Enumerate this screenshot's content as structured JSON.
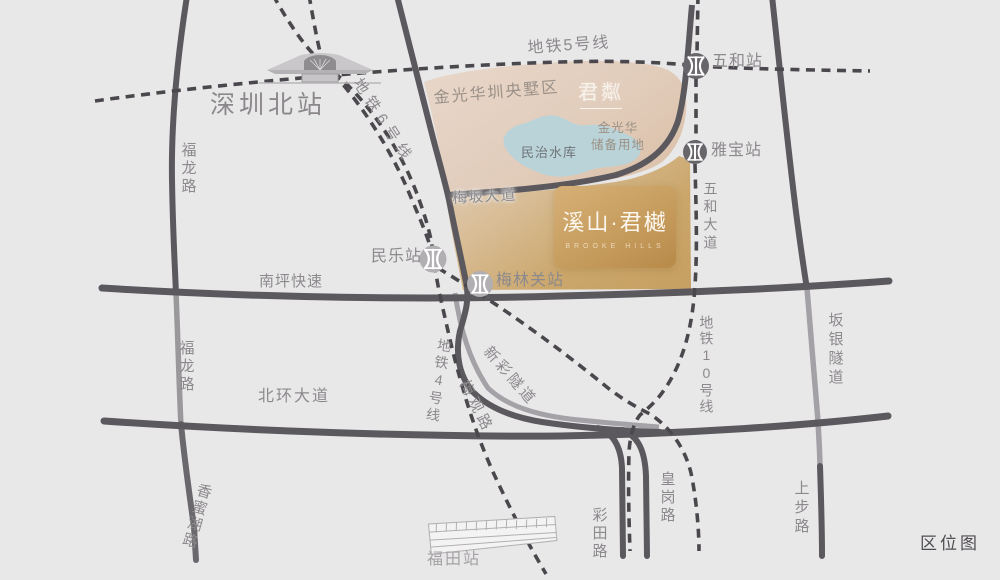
{
  "map_title": "区位图",
  "project": {
    "name": "溪山·君樾",
    "name_en": "BROOKE HILLS"
  },
  "stations": {
    "shenzhen_north": "深圳北站",
    "futian": "福田站",
    "wuhe": "五和站",
    "yabao": "雅宝站",
    "minle": "民乐站",
    "meilinguan": "梅林关站"
  },
  "metro_lines": {
    "line5": "地铁5号线",
    "line6": "地铁6号线",
    "line4": "地铁4号线",
    "line10": "地铁10号线"
  },
  "roads": {
    "fulong_upper": "福龙路",
    "fulong_lower": "福龙路",
    "xiangmihu": "香蜜湖路",
    "nanping_expressway": "南坪快速",
    "beihuan_avenue": "北环大道",
    "meiban_avenue": "梅坂大道",
    "wuhe_avenue": "五和大道",
    "banyin_tunnel": "坂银隧道",
    "shangbu": "上步路",
    "caitian": "彩田路",
    "huanggang": "皇岗路",
    "meiguan": "梅观路",
    "xincai_tunnel": "新彩隧道"
  },
  "areas": {
    "jinguanghua_zone": "金光华圳央墅区",
    "reserve_line1": "金光华",
    "reserve_line2": "储备用地",
    "lake": "民治水库",
    "junlin_logo": "君粼"
  },
  "colors": {
    "background": "#e9e8e9",
    "road_dark": "#5c595e",
    "road_light": "#a2a0a4",
    "metro_dash": "#4b484d",
    "beige_zone": "#e2cfc0",
    "gold_accent": "#c39a5c",
    "lake_blue": "#b9d3d9",
    "label_gray": "#8c898c"
  }
}
